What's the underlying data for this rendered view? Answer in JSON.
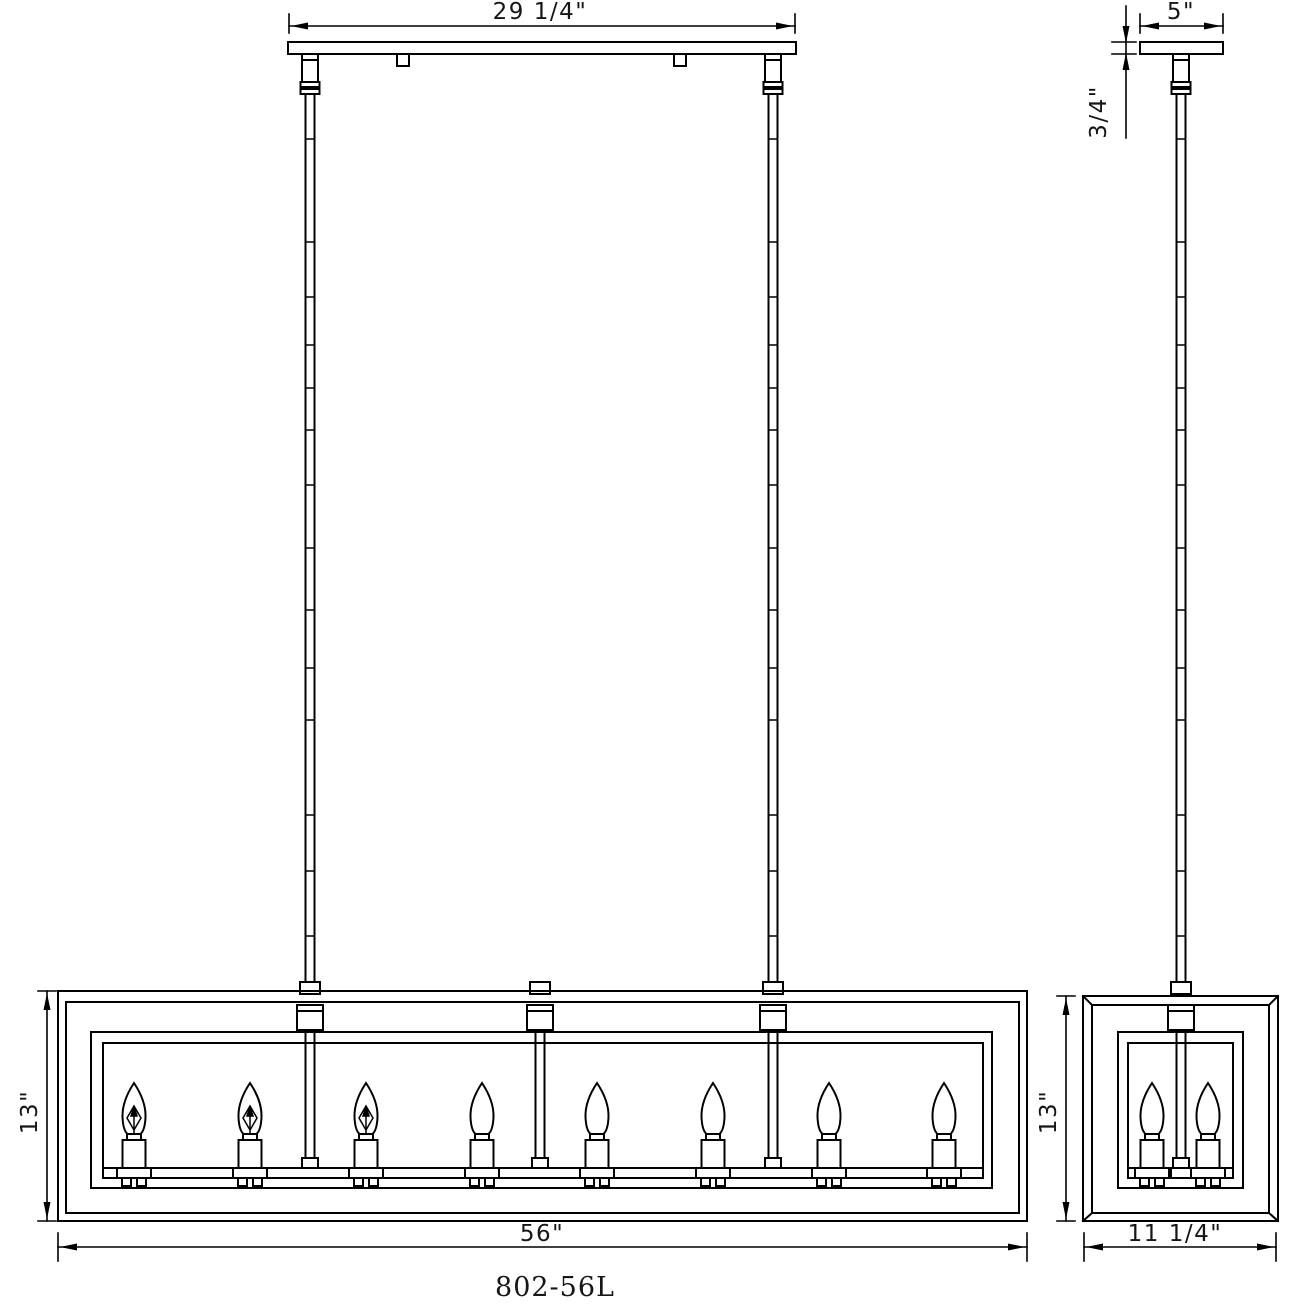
{
  "drawing": {
    "model_number": "802-56L",
    "colors": {
      "background": "#ffffff",
      "line": "#000000",
      "text": "#161616"
    },
    "front_view": {
      "canopy_width_label": "29 1/4\"",
      "fixture_width_label": "56\"",
      "fixture_height_label": "13\"",
      "light_count": 8
    },
    "side_view": {
      "canopy_width_label": "5\"",
      "canopy_thickness_label": "3/4\"",
      "fixture_depth_label": "11 1/4\"",
      "fixture_height_label": "13\"",
      "light_count": 2
    }
  }
}
